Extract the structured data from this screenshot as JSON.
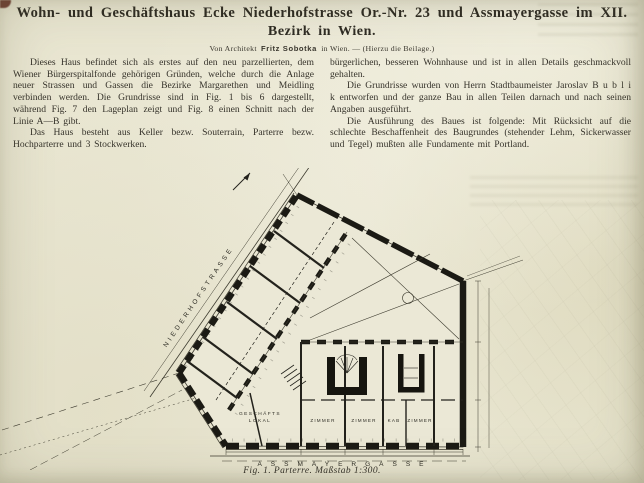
{
  "colors": {
    "paper": "#e9e6d1",
    "ink": "#34312a",
    "plan_ink": "#23221c",
    "corner_artifact": "#5e241b"
  },
  "header": {
    "title_line1": "Wohn- und Geschäftshaus Ecke Niederhofstrasse Or.-Nr. 23 und Assmayergasse im XII.",
    "title_line2": "Bezirk in Wien.",
    "byline_prefix": "Von Architekt",
    "byline_author": "Fritz Sobotka",
    "byline_suffix": "in Wien. — (Hierzu die Beilage.)"
  },
  "columns": {
    "left": [
      "Dieses Haus befindet sich als erstes auf den neu parzellierten, dem Wiener Bürgerspitalfonde gehörigen Gründen, welche durch die Anlage neuer Strassen und Gassen die Bezirke Margarethen und Meidling verbinden werden. Die Grundrisse sind in Fig. 1 bis 6 dargestellt, während Fig. 7 den Lageplan zeigt und Fig. 8 einen Schnitt nach der Linie A—B gibt.",
      "Das Haus besteht aus Keller bezw. Souterrain, Parterre bezw. Hochparterre und 3 Stockwerken."
    ],
    "right": [
      "bürgerlichen, besseren Wohnhause und ist in allen Details geschmackvoll gehalten.",
      "Die Grundrisse wurden von Herrn Stadtbaumeister Jaroslav B u b l i k entworfen und der ganze Bau in allen Teilen darnach und nach seinen Angaben ausgeführt.",
      "Die Ausführung des Baues ist folgende: Mit Rücksicht auf die schlechte Beschaffenheit des Baugrundes (stehender Lehm, Sickerwasser und Tegel) mußten alle Fundamente mit Portland."
    ]
  },
  "figure": {
    "street_label_diagonal": "NIEDERHOFSTRASSE",
    "street_label_bottom": "ASSMAYERGASSE",
    "shop_label_line1": "GESCHÄFTS",
    "shop_label_line2": "LOKAL",
    "room_labels": [
      "ZIMMER",
      "ZIMMER",
      "KAB",
      "ZIMMER"
    ],
    "caption": "Fig. 1. Parterre. Maßstab 1:300."
  }
}
